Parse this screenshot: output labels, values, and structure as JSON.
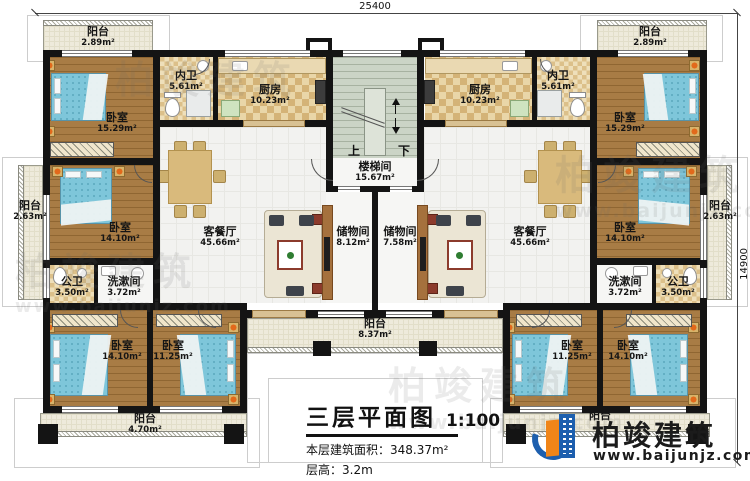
{
  "dimensions": {
    "top": "25400",
    "right": "14900"
  },
  "stair": {
    "up": "上",
    "down": "下"
  },
  "rooms": {
    "balcony_tl": {
      "label": "阳台",
      "area": "2.89m²"
    },
    "bedroom_tl": {
      "label": "卧室",
      "area": "15.29m²"
    },
    "bath_inner_l": {
      "label": "内卫",
      "area": "5.61m²"
    },
    "kitchen_l": {
      "label": "厨房",
      "area": "10.23m²"
    },
    "balcony_ml": {
      "label": "阳台",
      "area": "2.63m²"
    },
    "bedroom_ml": {
      "label": "卧室",
      "area": "14.10m²"
    },
    "bath_public_l": {
      "label": "公卫",
      "area": "3.50m²"
    },
    "washroom_l": {
      "label": "洗漱间",
      "area": "3.72m²"
    },
    "living_l": {
      "label": "客餐厅",
      "area": "45.66m²"
    },
    "storage_l": {
      "label": "储物间",
      "area": "8.12m²"
    },
    "stairwell": {
      "label": "楼梯间",
      "area": "15.67m²"
    },
    "balcony_bc": {
      "label": "阳台",
      "area": "8.37m²"
    },
    "bedroom_bl1": {
      "label": "卧室",
      "area": "14.10m²"
    },
    "bedroom_bl2": {
      "label": "卧室",
      "area": "11.25m²"
    },
    "balcony_bl": {
      "label": "阳台",
      "area": "4.70m²"
    },
    "storage_r": {
      "label": "储物间",
      "area": "7.58m²"
    },
    "living_r": {
      "label": "客餐厅",
      "area": "45.66m²"
    },
    "kitchen_r": {
      "label": "厨房",
      "area": "10.23m²"
    },
    "bath_inner_r": {
      "label": "内卫",
      "area": "5.61m²"
    },
    "balcony_tr": {
      "label": "阳台",
      "area": "2.89m²"
    },
    "bedroom_tr": {
      "label": "卧室",
      "area": "15.29m²"
    },
    "balcony_mr": {
      "label": "阳台",
      "area": "2.63m²"
    },
    "bedroom_mr": {
      "label": "卧室",
      "area": "14.10m²"
    },
    "washroom_r": {
      "label": "洗漱间",
      "area": "3.72m²"
    },
    "bath_public_r": {
      "label": "公卫",
      "area": "3.50m²"
    },
    "bedroom_br1": {
      "label": "卧室",
      "area": "11.25m²"
    },
    "bedroom_br2": {
      "label": "卧室",
      "area": "14.10m²"
    },
    "balcony_br": {
      "label": "阳台",
      "area": ""
    }
  },
  "title_block": {
    "title": "三层平面图",
    "scale": "1:100",
    "area_line": "本层建筑面积：348.37m²",
    "height_line": "层高：3.2m"
  },
  "logo": {
    "name": "柏竣建筑",
    "website": "www.baijunjz.com"
  },
  "watermark": {
    "text": "柏竣建筑",
    "site": "www.baijunjz.com"
  },
  "colors": {
    "wall": "#141414",
    "wood_floor": "#a87c45",
    "bed": "#7ec6da",
    "logo_blue": "#1d5fae",
    "logo_orange": "#f08519"
  }
}
